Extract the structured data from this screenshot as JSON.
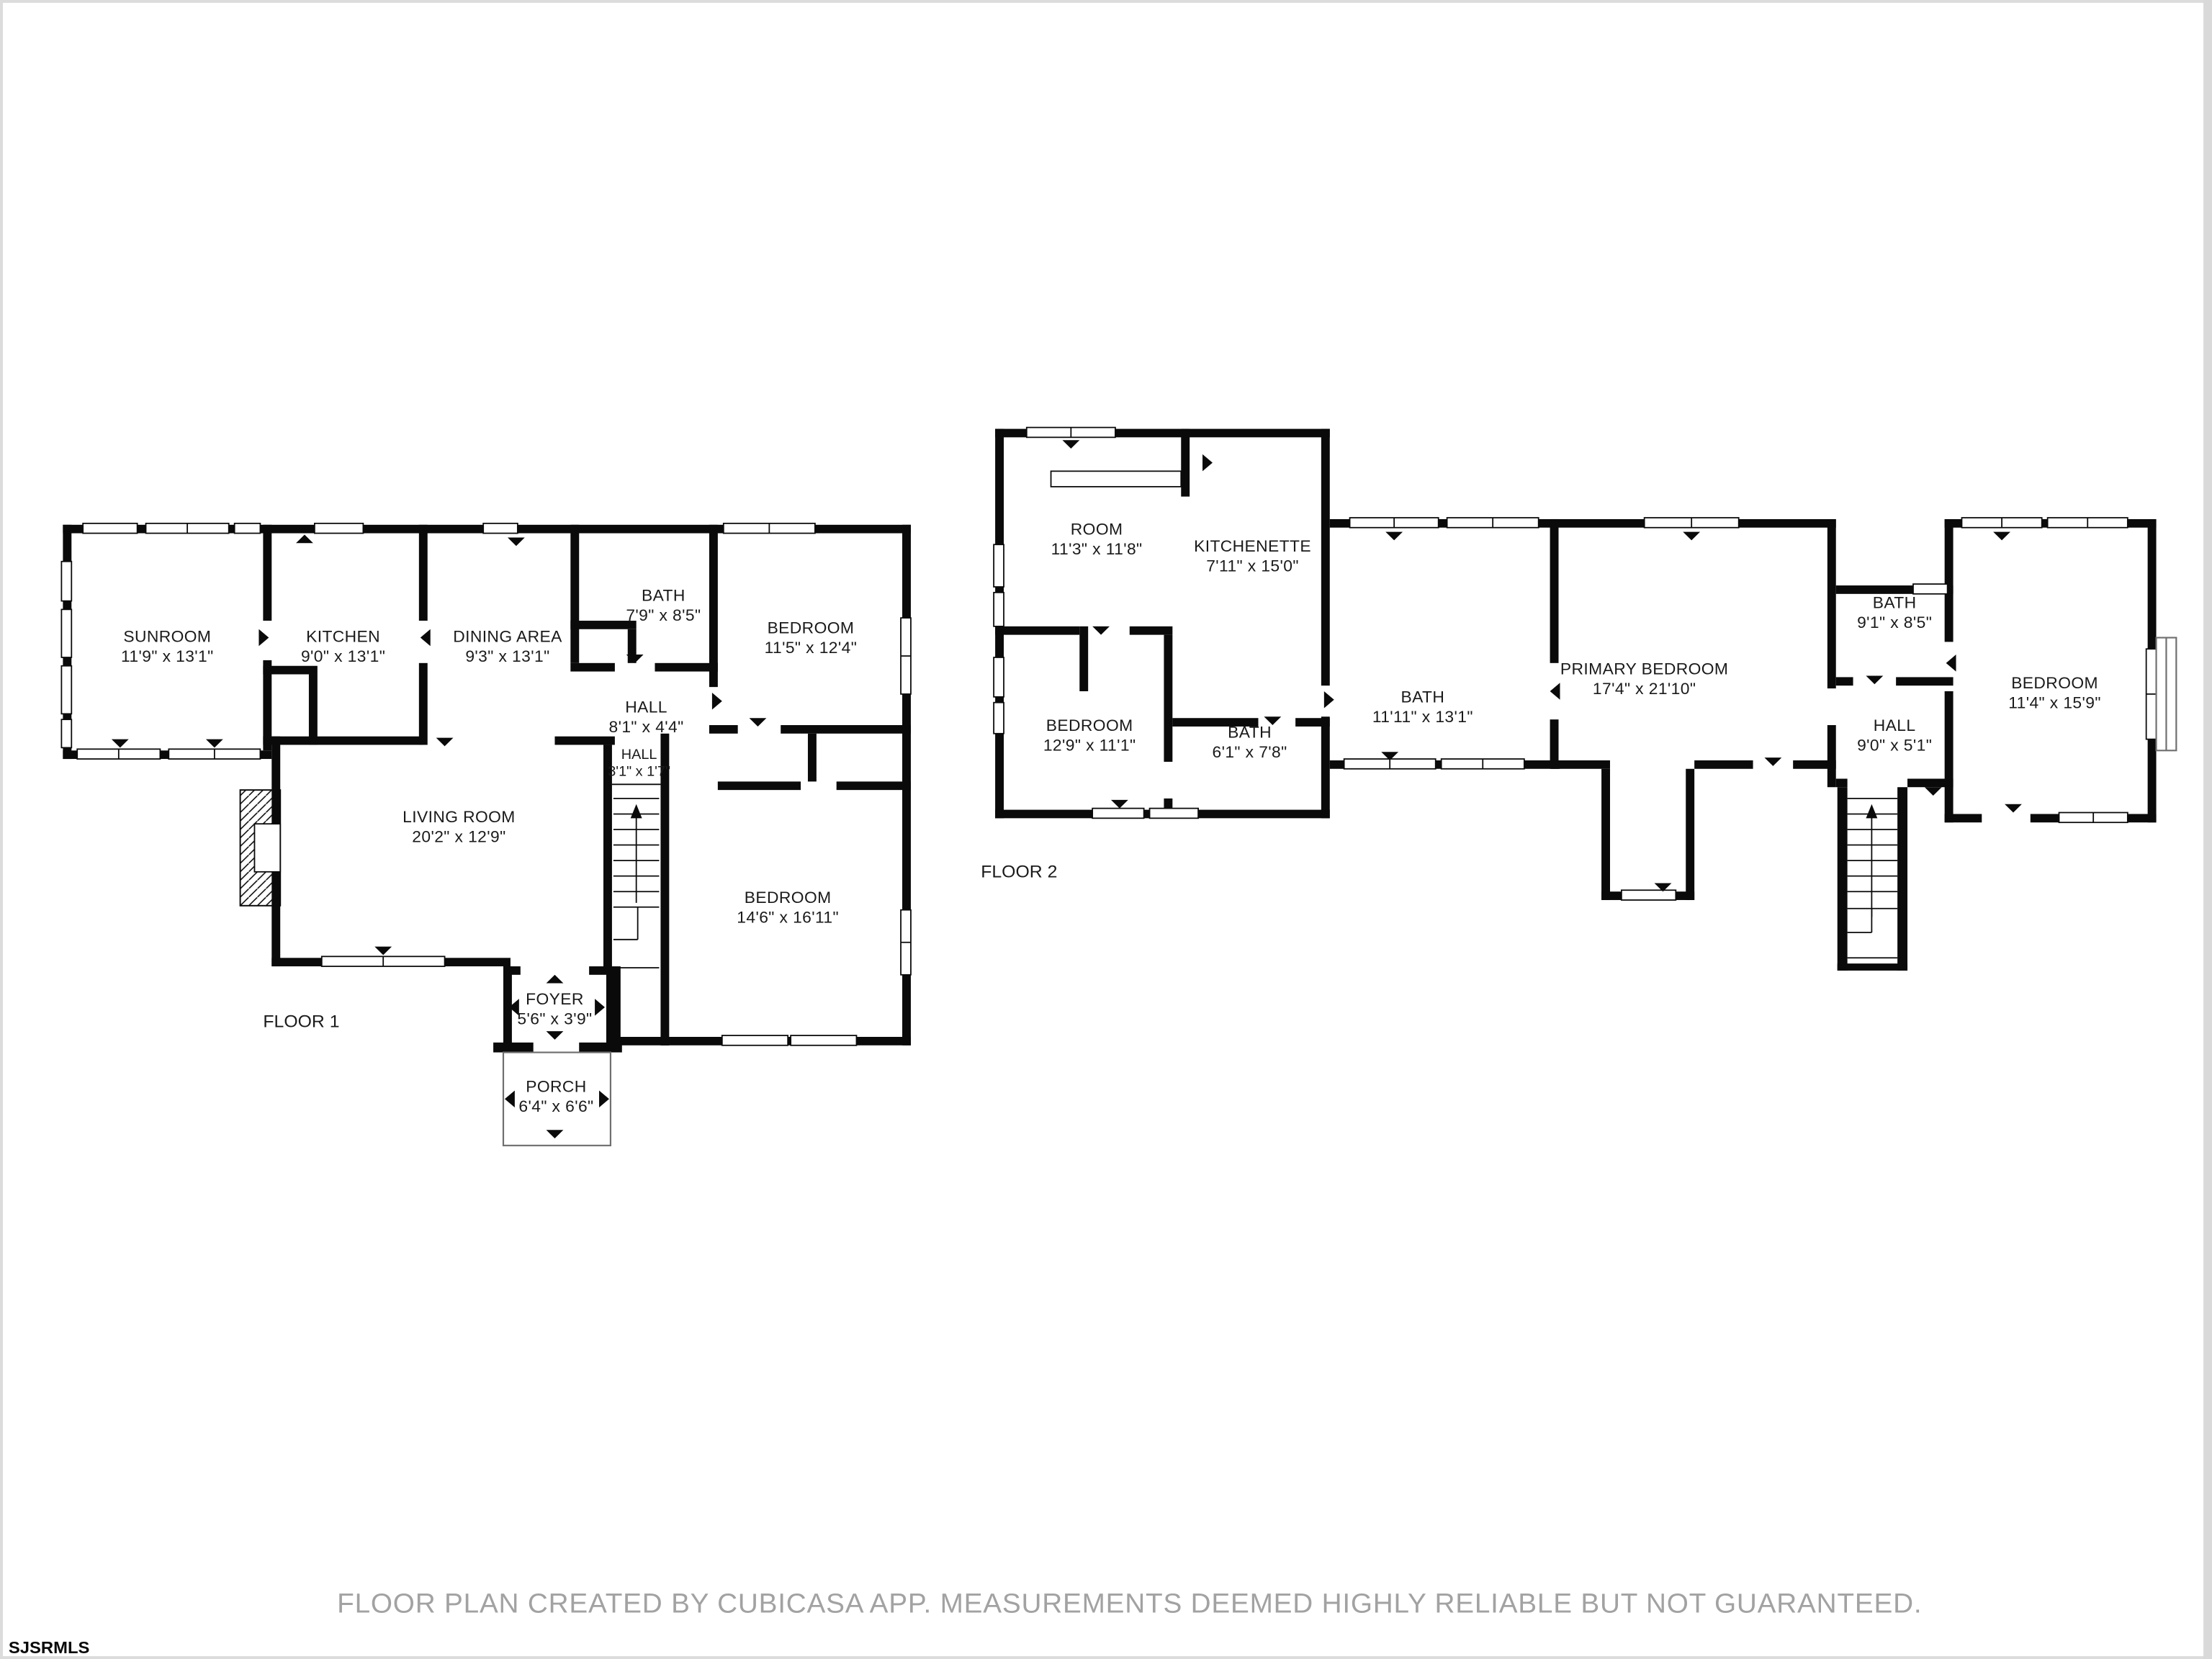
{
  "page": {
    "footer_disclaimer": "FLOOR PLAN CREATED BY CUBICASA APP. MEASUREMENTS DEEMED HIGHLY RELIABLE BUT NOT GUARANTEED.",
    "watermark": "SJSRMLS"
  },
  "colors": {
    "wall": "#0a0a0a",
    "label_text": "#1a1a1a",
    "footer_text": "#a2a2a2",
    "page_border": "#d9d9d9"
  },
  "floor1": {
    "label": "FLOOR 1",
    "rooms": {
      "sunroom": {
        "name": "SUNROOM",
        "dims": "11'9\" x 13'1\""
      },
      "kitchen": {
        "name": "KITCHEN",
        "dims": "9'0\" x 13'1\""
      },
      "dining": {
        "name": "DINING AREA",
        "dims": "9'3\" x 13'1\""
      },
      "bath": {
        "name": "BATH",
        "dims": "7'9\" x 8'5\""
      },
      "bedroom1": {
        "name": "BEDROOM",
        "dims": "11'5\" x 12'4\""
      },
      "hall": {
        "name": "HALL",
        "dims": "8'1\" x 4'4\""
      },
      "hall2": {
        "name": "HALL",
        "dims": "3'1\" x 1'7\""
      },
      "living": {
        "name": "LIVING ROOM",
        "dims": "20'2\" x 12'9\""
      },
      "bedroom2": {
        "name": "BEDROOM",
        "dims": "14'6\" x 16'11\""
      },
      "foyer": {
        "name": "FOYER",
        "dims": "5'6\" x 3'9\""
      },
      "porch": {
        "name": "PORCH",
        "dims": "6'4\" x 6'6\""
      }
    }
  },
  "floor2": {
    "label": "FLOOR 2",
    "rooms": {
      "room": {
        "name": "ROOM",
        "dims": "11'3\" x 11'8\""
      },
      "kitchenette": {
        "name": "KITCHENETTE",
        "dims": "7'11\" x 15'0\""
      },
      "bedroom1": {
        "name": "BEDROOM",
        "dims": "12'9\" x 11'1\""
      },
      "bath1": {
        "name": "BATH",
        "dims": "6'1\" x 7'8\""
      },
      "bath2": {
        "name": "BATH",
        "dims": "11'11\" x 13'1\""
      },
      "primary": {
        "name": "PRIMARY BEDROOM",
        "dims": "17'4\" x 21'10\""
      },
      "bath3": {
        "name": "BATH",
        "dims": "9'1\" x 8'5\""
      },
      "hall": {
        "name": "HALL",
        "dims": "9'0\" x 5'1\""
      },
      "bedroom2": {
        "name": "BEDROOM",
        "dims": "11'4\" x 15'9\""
      }
    }
  }
}
